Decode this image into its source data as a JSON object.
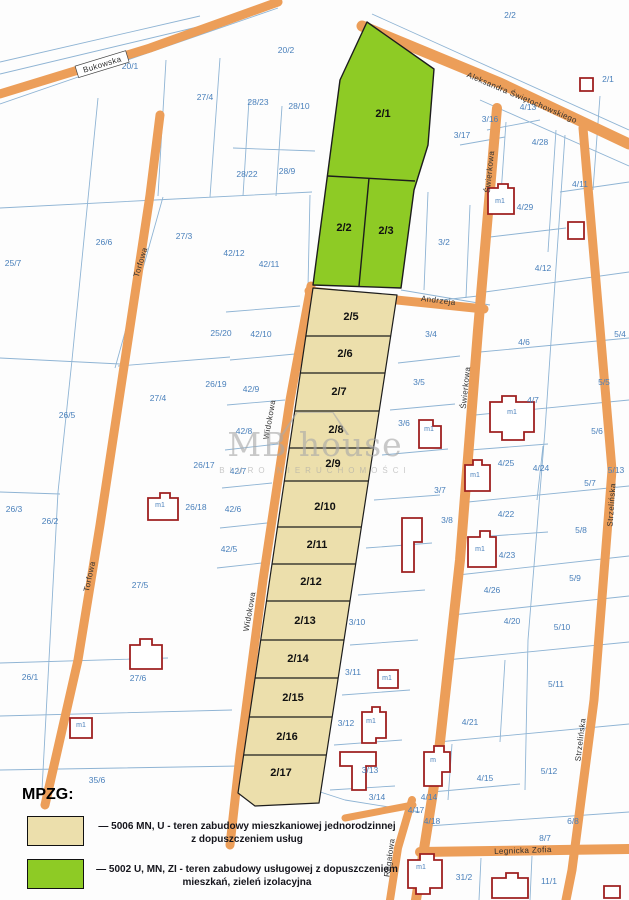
{
  "legend": {
    "title": "MPZG:",
    "items": [
      {
        "zone": "mn_u",
        "line1": "— 5006 MN, U - teren zabudowy mieszkaniowej jednorodzinnej",
        "line2": "z dopuszczeniem usług"
      },
      {
        "zone": "u_mn_zi",
        "line1": "— 5002 U, MN, ZI - teren zabudowy usługowej z dopuszczeniem",
        "line2": "mieszkań, zieleń izolacyjna"
      }
    ]
  },
  "watermark": {
    "title": "MB house",
    "subtitle": "BIURO NIERUCHOMOŚCI"
  },
  "colors": {
    "road": "#ec9e59",
    "parcel_line": "#8fb4d4",
    "parcel_number": "#4a80bb",
    "mn_u": "#ecdfac",
    "u_mn_zi": "#8ecb25",
    "building": "#9e2020"
  },
  "map": {
    "plot_labels_green": [
      {
        "t": "2/1",
        "x": 383,
        "y": 117
      },
      {
        "t": "2/2",
        "x": 344,
        "y": 231
      },
      {
        "t": "2/3",
        "x": 386,
        "y": 234
      }
    ],
    "plot_labels_tan": [
      {
        "t": "2/5",
        "x": 351,
        "y": 320
      },
      {
        "t": "2/6",
        "x": 345,
        "y": 357
      },
      {
        "t": "2/7",
        "x": 339,
        "y": 395
      },
      {
        "t": "2/8",
        "x": 336,
        "y": 433
      },
      {
        "t": "2/9",
        "x": 333,
        "y": 467
      },
      {
        "t": "2/10",
        "x": 325,
        "y": 510
      },
      {
        "t": "2/11",
        "x": 317,
        "y": 548
      },
      {
        "t": "2/12",
        "x": 311,
        "y": 585
      },
      {
        "t": "2/13",
        "x": 305,
        "y": 624
      },
      {
        "t": "2/14",
        "x": 298,
        "y": 662
      },
      {
        "t": "2/15",
        "x": 293,
        "y": 701
      },
      {
        "t": "2/16",
        "x": 287,
        "y": 740
      },
      {
        "t": "2/17",
        "x": 281,
        "y": 776
      }
    ],
    "parcel_numbers": [
      {
        "t": "20/1",
        "x": 130,
        "y": 69
      },
      {
        "t": "20/2",
        "x": 286,
        "y": 53
      },
      {
        "t": "2/2",
        "x": 510,
        "y": 18
      },
      {
        "t": "2/1",
        "x": 608,
        "y": 82
      },
      {
        "t": "27/4",
        "x": 205,
        "y": 100
      },
      {
        "t": "28/23",
        "x": 258,
        "y": 105
      },
      {
        "t": "28/10",
        "x": 299,
        "y": 109
      },
      {
        "t": "28/22",
        "x": 247,
        "y": 177
      },
      {
        "t": "28/9",
        "x": 287,
        "y": 174
      },
      {
        "t": "3/16",
        "x": 490,
        "y": 122
      },
      {
        "t": "3/17",
        "x": 462,
        "y": 138
      },
      {
        "t": "4/13",
        "x": 528,
        "y": 110
      },
      {
        "t": "4/28",
        "x": 540,
        "y": 145
      },
      {
        "t": "4/29",
        "x": 525,
        "y": 210
      },
      {
        "t": "4/11",
        "x": 580,
        "y": 187
      },
      {
        "t": "4/12",
        "x": 543,
        "y": 271
      },
      {
        "t": "3/2",
        "x": 444,
        "y": 245
      },
      {
        "t": "3/4",
        "x": 431,
        "y": 337
      },
      {
        "t": "4/6",
        "x": 524,
        "y": 345
      },
      {
        "t": "5/4",
        "x": 620,
        "y": 337
      },
      {
        "t": "3/5",
        "x": 419,
        "y": 385
      },
      {
        "t": "4/7",
        "x": 533,
        "y": 403
      },
      {
        "t": "5/5",
        "x": 604,
        "y": 385
      },
      {
        "t": "3/6",
        "x": 404,
        "y": 426
      },
      {
        "t": "5/6",
        "x": 597,
        "y": 434
      },
      {
        "t": "4/25",
        "x": 506,
        "y": 466
      },
      {
        "t": "4/24",
        "x": 541,
        "y": 471
      },
      {
        "t": "5/13",
        "x": 616,
        "y": 473
      },
      {
        "t": "5/7",
        "x": 590,
        "y": 486
      },
      {
        "t": "3/7",
        "x": 440,
        "y": 493
      },
      {
        "t": "4/22",
        "x": 506,
        "y": 517
      },
      {
        "t": "3/8",
        "x": 447,
        "y": 523
      },
      {
        "t": "5/8",
        "x": 581,
        "y": 533
      },
      {
        "t": "4/23",
        "x": 507,
        "y": 558
      },
      {
        "t": "4/26",
        "x": 492,
        "y": 593
      },
      {
        "t": "5/9",
        "x": 575,
        "y": 581
      },
      {
        "t": "4/20",
        "x": 512,
        "y": 624
      },
      {
        "t": "5/10",
        "x": 562,
        "y": 630
      },
      {
        "t": "3/10",
        "x": 357,
        "y": 625
      },
      {
        "t": "3/11",
        "x": 353,
        "y": 675
      },
      {
        "t": "5/11",
        "x": 556,
        "y": 687
      },
      {
        "t": "4/21",
        "x": 470,
        "y": 725
      },
      {
        "t": "3/12",
        "x": 346,
        "y": 726
      },
      {
        "t": "5/12",
        "x": 549,
        "y": 774
      },
      {
        "t": "3/13",
        "x": 370,
        "y": 773
      },
      {
        "t": "4/15",
        "x": 485,
        "y": 781
      },
      {
        "t": "3/14",
        "x": 377,
        "y": 800
      },
      {
        "t": "4/14",
        "x": 429,
        "y": 800
      },
      {
        "t": "4/17",
        "x": 416,
        "y": 813
      },
      {
        "t": "4/18",
        "x": 432,
        "y": 824
      },
      {
        "t": "6/8",
        "x": 573,
        "y": 824
      },
      {
        "t": "8/7",
        "x": 545,
        "y": 841
      },
      {
        "t": "31/2",
        "x": 464,
        "y": 880
      },
      {
        "t": "11/1",
        "x": 549,
        "y": 884
      },
      {
        "t": "25/7",
        "x": 13,
        "y": 266
      },
      {
        "t": "26/6",
        "x": 104,
        "y": 245
      },
      {
        "t": "27/3",
        "x": 184,
        "y": 239
      },
      {
        "t": "42/12",
        "x": 234,
        "y": 256
      },
      {
        "t": "42/11",
        "x": 269,
        "y": 267
      },
      {
        "t": "25/20",
        "x": 221,
        "y": 336
      },
      {
        "t": "26/19",
        "x": 216,
        "y": 387
      },
      {
        "t": "27/4",
        "x": 158,
        "y": 401
      },
      {
        "t": "26/5",
        "x": 67,
        "y": 418
      },
      {
        "t": "42/10",
        "x": 261,
        "y": 337
      },
      {
        "t": "42/9",
        "x": 251,
        "y": 392
      },
      {
        "t": "42/8",
        "x": 244,
        "y": 434
      },
      {
        "t": "42/7",
        "x": 238,
        "y": 474
      },
      {
        "t": "42/6",
        "x": 233,
        "y": 512
      },
      {
        "t": "42/5",
        "x": 229,
        "y": 552
      },
      {
        "t": "26/17",
        "x": 204,
        "y": 468
      },
      {
        "t": "26/18",
        "x": 196,
        "y": 510
      },
      {
        "t": "26/3",
        "x": 14,
        "y": 512
      },
      {
        "t": "26/2",
        "x": 50,
        "y": 524
      },
      {
        "t": "27/5",
        "x": 140,
        "y": 588
      },
      {
        "t": "26/1",
        "x": 30,
        "y": 680
      },
      {
        "t": "27/6",
        "x": 138,
        "y": 681
      },
      {
        "t": "35/6",
        "x": 97,
        "y": 783
      }
    ],
    "road_labels": [
      {
        "t": "Bukowska",
        "x": 103,
        "y": 67,
        "r": -17,
        "plate": true
      },
      {
        "t": "Aleksandra Świętochowskiego",
        "x": 521,
        "y": 100,
        "r": 23
      },
      {
        "t": "Torfowa",
        "x": 143,
        "y": 263,
        "r": -73
      },
      {
        "t": "Torfowa",
        "x": 92,
        "y": 577,
        "r": -78
      },
      {
        "t": "Widokowa",
        "x": 272,
        "y": 420,
        "r": -80
      },
      {
        "t": "Widokowa",
        "x": 252,
        "y": 612,
        "r": -80
      },
      {
        "t": "Świerkowa",
        "x": 492,
        "y": 172,
        "r": -84
      },
      {
        "t": "Świerkowa",
        "x": 468,
        "y": 388,
        "r": -84
      },
      {
        "t": "Andrzeja",
        "x": 438,
        "y": 303,
        "r": 7
      },
      {
        "t": "Strzelińska",
        "x": 614,
        "y": 505,
        "r": -86
      },
      {
        "t": "Strzelińska",
        "x": 583,
        "y": 740,
        "r": -83
      },
      {
        "t": "Regałowa",
        "x": 392,
        "y": 858,
        "r": -82
      },
      {
        "t": "Legnicka Zofia",
        "x": 523,
        "y": 853,
        "r": -2
      }
    ],
    "building_labels": [
      {
        "t": "m1",
        "x": 500,
        "y": 203
      },
      {
        "t": "m1",
        "x": 429,
        "y": 431
      },
      {
        "t": "m1",
        "x": 512,
        "y": 414
      },
      {
        "t": "m1",
        "x": 475,
        "y": 477
      },
      {
        "t": "m1",
        "x": 480,
        "y": 551
      },
      {
        "t": "m1",
        "x": 387,
        "y": 680
      },
      {
        "t": "m1",
        "x": 371,
        "y": 723
      },
      {
        "t": "m",
        "x": 433,
        "y": 762
      },
      {
        "t": "m1",
        "x": 421,
        "y": 869
      },
      {
        "t": "m1",
        "x": 160,
        "y": 507
      },
      {
        "t": "m1",
        "x": 81,
        "y": 727
      }
    ]
  }
}
